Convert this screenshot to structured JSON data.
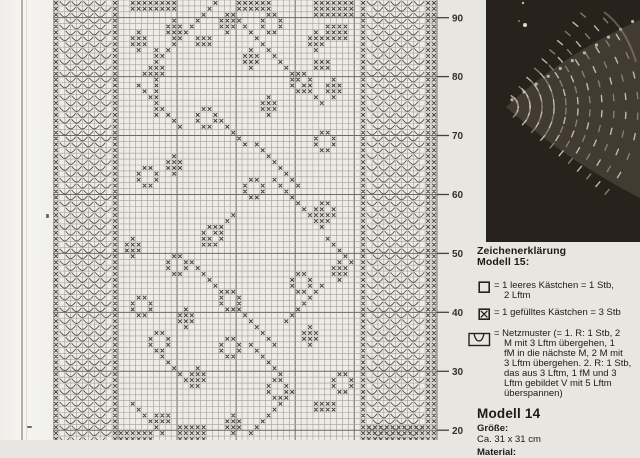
{
  "page": {
    "bg": "#e8e6e1"
  },
  "chart": {
    "cols": 65,
    "rows": 75,
    "cell_w": 5.907,
    "cell_h": 5.893,
    "colors": {
      "bg": "#edece7",
      "grid": "#a29d95",
      "grid_bold": "#6f6a62",
      "mark": "#46423b",
      "fan": "#57534c",
      "tick": "#45423c",
      "label": "#33312c"
    },
    "x_border_cols": [
      0,
      10,
      52,
      63,
      64
    ],
    "v_bands": [
      [
        1,
        9
      ],
      [
        53,
        62
      ]
    ],
    "bold_v_lines": [
      11,
      21,
      31,
      41,
      51
    ],
    "bold_h_rows": [
      3,
      13,
      23,
      33,
      43,
      53,
      63,
      73
    ],
    "axis": {
      "labels": [
        "90",
        "80",
        "70",
        "60",
        "50",
        "40",
        "30",
        "20"
      ],
      "y_px": [
        17.7,
        76.6,
        135.5,
        194.5,
        253.4,
        312.3,
        371.3,
        430.2
      ],
      "tick_len": 12
    },
    "motifs": {
      "flowers": [
        [
          2,
          35
        ],
        [
          12,
          40
        ],
        [
          18,
          24
        ],
        [
          22,
          44
        ],
        [
          28,
          14
        ],
        [
          30,
          32
        ],
        [
          34,
          44
        ],
        [
          38,
          25
        ],
        [
          43,
          19
        ],
        [
          46,
          40
        ],
        [
          49,
          28
        ],
        [
          50,
          13
        ],
        [
          56,
          16
        ],
        [
          57,
          28
        ],
        [
          63,
          47
        ],
        [
          64,
          36
        ]
      ],
      "diamonds": [
        [
          5,
          14
        ],
        [
          3,
          20
        ],
        [
          10,
          17
        ],
        [
          2,
          29
        ],
        [
          8,
          33
        ],
        [
          5,
          44
        ],
        [
          13,
          47
        ],
        [
          26,
          20
        ],
        [
          35,
          45
        ],
        [
          55,
          43
        ],
        [
          62,
          24
        ],
        [
          70,
          30
        ],
        [
          40,
          13
        ],
        [
          16,
          36
        ],
        [
          44,
          48
        ],
        [
          52,
          22
        ]
      ],
      "diagonals": [
        [
          0,
          27,
          13,
          -1
        ],
        [
          2,
          30,
          16,
          1
        ],
        [
          8,
          17,
          12,
          0
        ],
        [
          14,
          14,
          8,
          1
        ],
        [
          20,
          28,
          5,
          1
        ],
        [
          24,
          34,
          8,
          1
        ],
        [
          30,
          37,
          7,
          1
        ],
        [
          36,
          30,
          6,
          -1
        ],
        [
          40,
          46,
          5,
          1
        ],
        [
          44,
          23,
          6,
          1
        ],
        [
          48,
          45,
          7,
          -1
        ],
        [
          52,
          31,
          7,
          1
        ],
        [
          58,
          33,
          6,
          1
        ],
        [
          60,
          18,
          6,
          1
        ],
        [
          66,
          40,
          8,
          -1
        ],
        [
          68,
          13,
          6,
          1
        ]
      ],
      "rects": [
        [
          0,
          13,
          8,
          2
        ],
        [
          0,
          31,
          6,
          2
        ],
        [
          0,
          44,
          7,
          3
        ],
        [
          4,
          46,
          4,
          3
        ],
        [
          6,
          24,
          3,
          2
        ],
        [
          10,
          44,
          3,
          2
        ],
        [
          68,
          44,
          4,
          2
        ],
        [
          70,
          17,
          3,
          2
        ],
        [
          72,
          21,
          5,
          3
        ],
        [
          72,
          53,
          12,
          3
        ],
        [
          73,
          11,
          6,
          2
        ]
      ]
    }
  },
  "photo": {
    "bg": "#28221c",
    "lace_light": "#cfc8bb",
    "lace_mid": "#8e8679",
    "lace_base": "#4a443a"
  },
  "legend": {
    "title_line1": "Zeichenerklärung",
    "title_line2": "Modell 15:",
    "items": [
      {
        "symbol": "empty-square",
        "text": "= 1 leeres Kästchen = 1 Stb,\n2 Lftm"
      },
      {
        "symbol": "x-square",
        "text": "= 1 gefülltes Kästchen = 3 Stb"
      },
      {
        "symbol": "net-v",
        "text": "= Netzmuster (= 1. R: 1 Stb, 2\nM mit 3 Lftm übergehen, 1\nfM in die nächste M, 2 M mit\n3 Lftm übergehen. 2. R: 1 Stb,\ndas aus 3 Lftm, 1 fM und 3\nLftm gebildet V mit 5 Lftm\nüberspannen)"
      }
    ]
  },
  "model14": {
    "title": "Modell 14",
    "size_label": "Größe:",
    "size_value": "Ca. 31 x 31 cm",
    "material_label": "Material:"
  }
}
